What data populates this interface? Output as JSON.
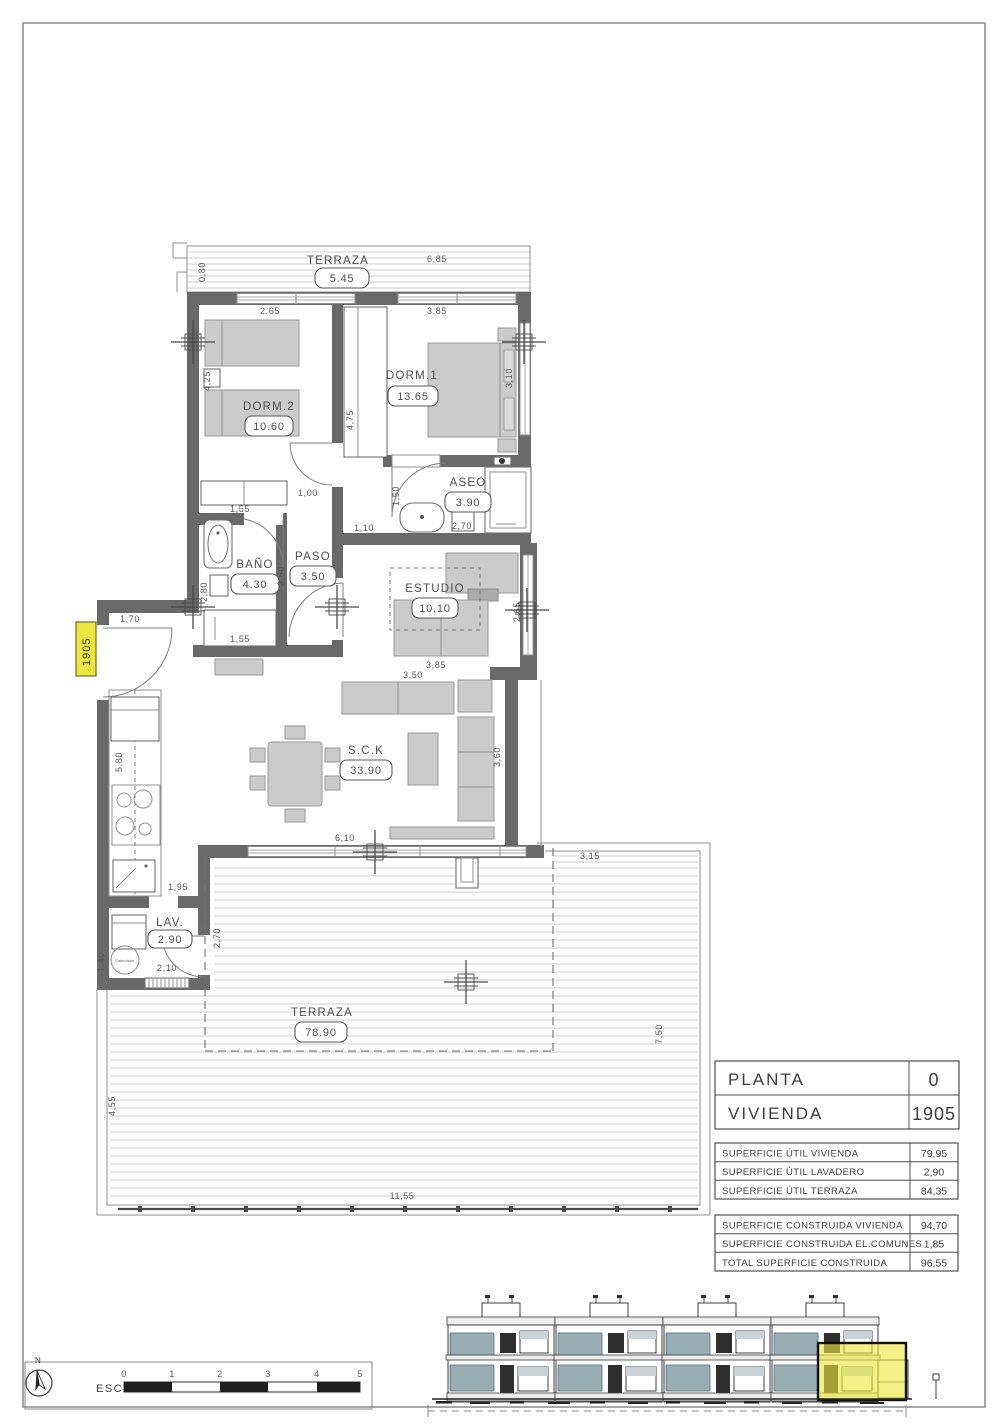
{
  "plan": {
    "tag": "1905",
    "lav_heater_label": "Calentador",
    "rooms": {
      "terraza_top": {
        "name": "TERRAZA",
        "area": "5.45"
      },
      "dorm2": {
        "name": "DORM.2",
        "area": "10.60"
      },
      "dorm1": {
        "name": "DORM.1",
        "area": "13.65"
      },
      "aseo": {
        "name": "ASEO",
        "area": "3.90"
      },
      "bano": {
        "name": "BAÑO",
        "area": "4.30"
      },
      "paso": {
        "name": "PASO",
        "area": "3.50"
      },
      "estudio": {
        "name": "ESTUDIO",
        "area": "10.10"
      },
      "sck": {
        "name": "S.C.K",
        "area": "33.90"
      },
      "lav": {
        "name": "LAV.",
        "area": "2.90"
      },
      "terraza_main": {
        "name": "TERRAZA",
        "area": "78.90"
      }
    },
    "dims": {
      "terraza_top_width": "6,85",
      "terraza_top_depth": "0,80",
      "dorm2_width": "2,65",
      "dorm1_width": "3,85",
      "dorm2_height": "4,25",
      "closet_height": "4,75",
      "dorm1_height": "3,10",
      "dorm2_wardrobe": "1,55",
      "paso_door": "1,00",
      "aseo_depth": "1,50",
      "aseo_width": "2,70",
      "paso_width": "1,10",
      "paso_height": "3,50",
      "bano_depth": "2,80",
      "bano_width": "1,55",
      "estudio_height": "2,65",
      "estudio_width": "3,85",
      "sofa_width": "3,50",
      "sck_height": "3,60",
      "entry_width": "1,70",
      "kitchen_height": "5,80",
      "sck_window": "6,10",
      "kitchen_width": "1,95",
      "lav_width": "2,10",
      "lav_height": "1,40",
      "lav_depth": "2,70",
      "terraza_right_offset": "3,15",
      "terraza_right_height": "7,50",
      "terraza_left_height": "4,55",
      "terraza_bottom_width": "11,55"
    }
  },
  "title_block": {
    "main_rows": [
      {
        "label": "PLANTA",
        "value": "0"
      },
      {
        "label": "VIVIENDA",
        "value": "1905"
      }
    ],
    "util_rows": [
      {
        "label": "SUPERFICIE ÚTIL VIVIENDA",
        "value": "79,95"
      },
      {
        "label": "SUPERFICIE ÚTIL LAVADERO",
        "value": "2,90"
      },
      {
        "label": "SUPERFICIE ÚTIL TERRAZA",
        "value": "84,35"
      }
    ],
    "built_rows": [
      {
        "label": "SUPERFICIE CONSTRUIDA VIVIENDA",
        "value": "94,70"
      },
      {
        "label": "SUPERFICIE CONSTRUIDA EL.COMUNES",
        "value": "1,85"
      },
      {
        "label": "TOTAL SUPERFICIE CONSTRUIDA",
        "value": "96,55"
      }
    ]
  },
  "scale_bar": {
    "label": "ESCALA :",
    "north": "N",
    "ticks": [
      "0",
      "1",
      "2",
      "3",
      "4",
      "5"
    ]
  },
  "colors": {
    "wall": "#696969",
    "highlight_yellow": "#ece73f",
    "furniture": "#cbcbcb",
    "balcony_teal": "#7f98a2"
  }
}
